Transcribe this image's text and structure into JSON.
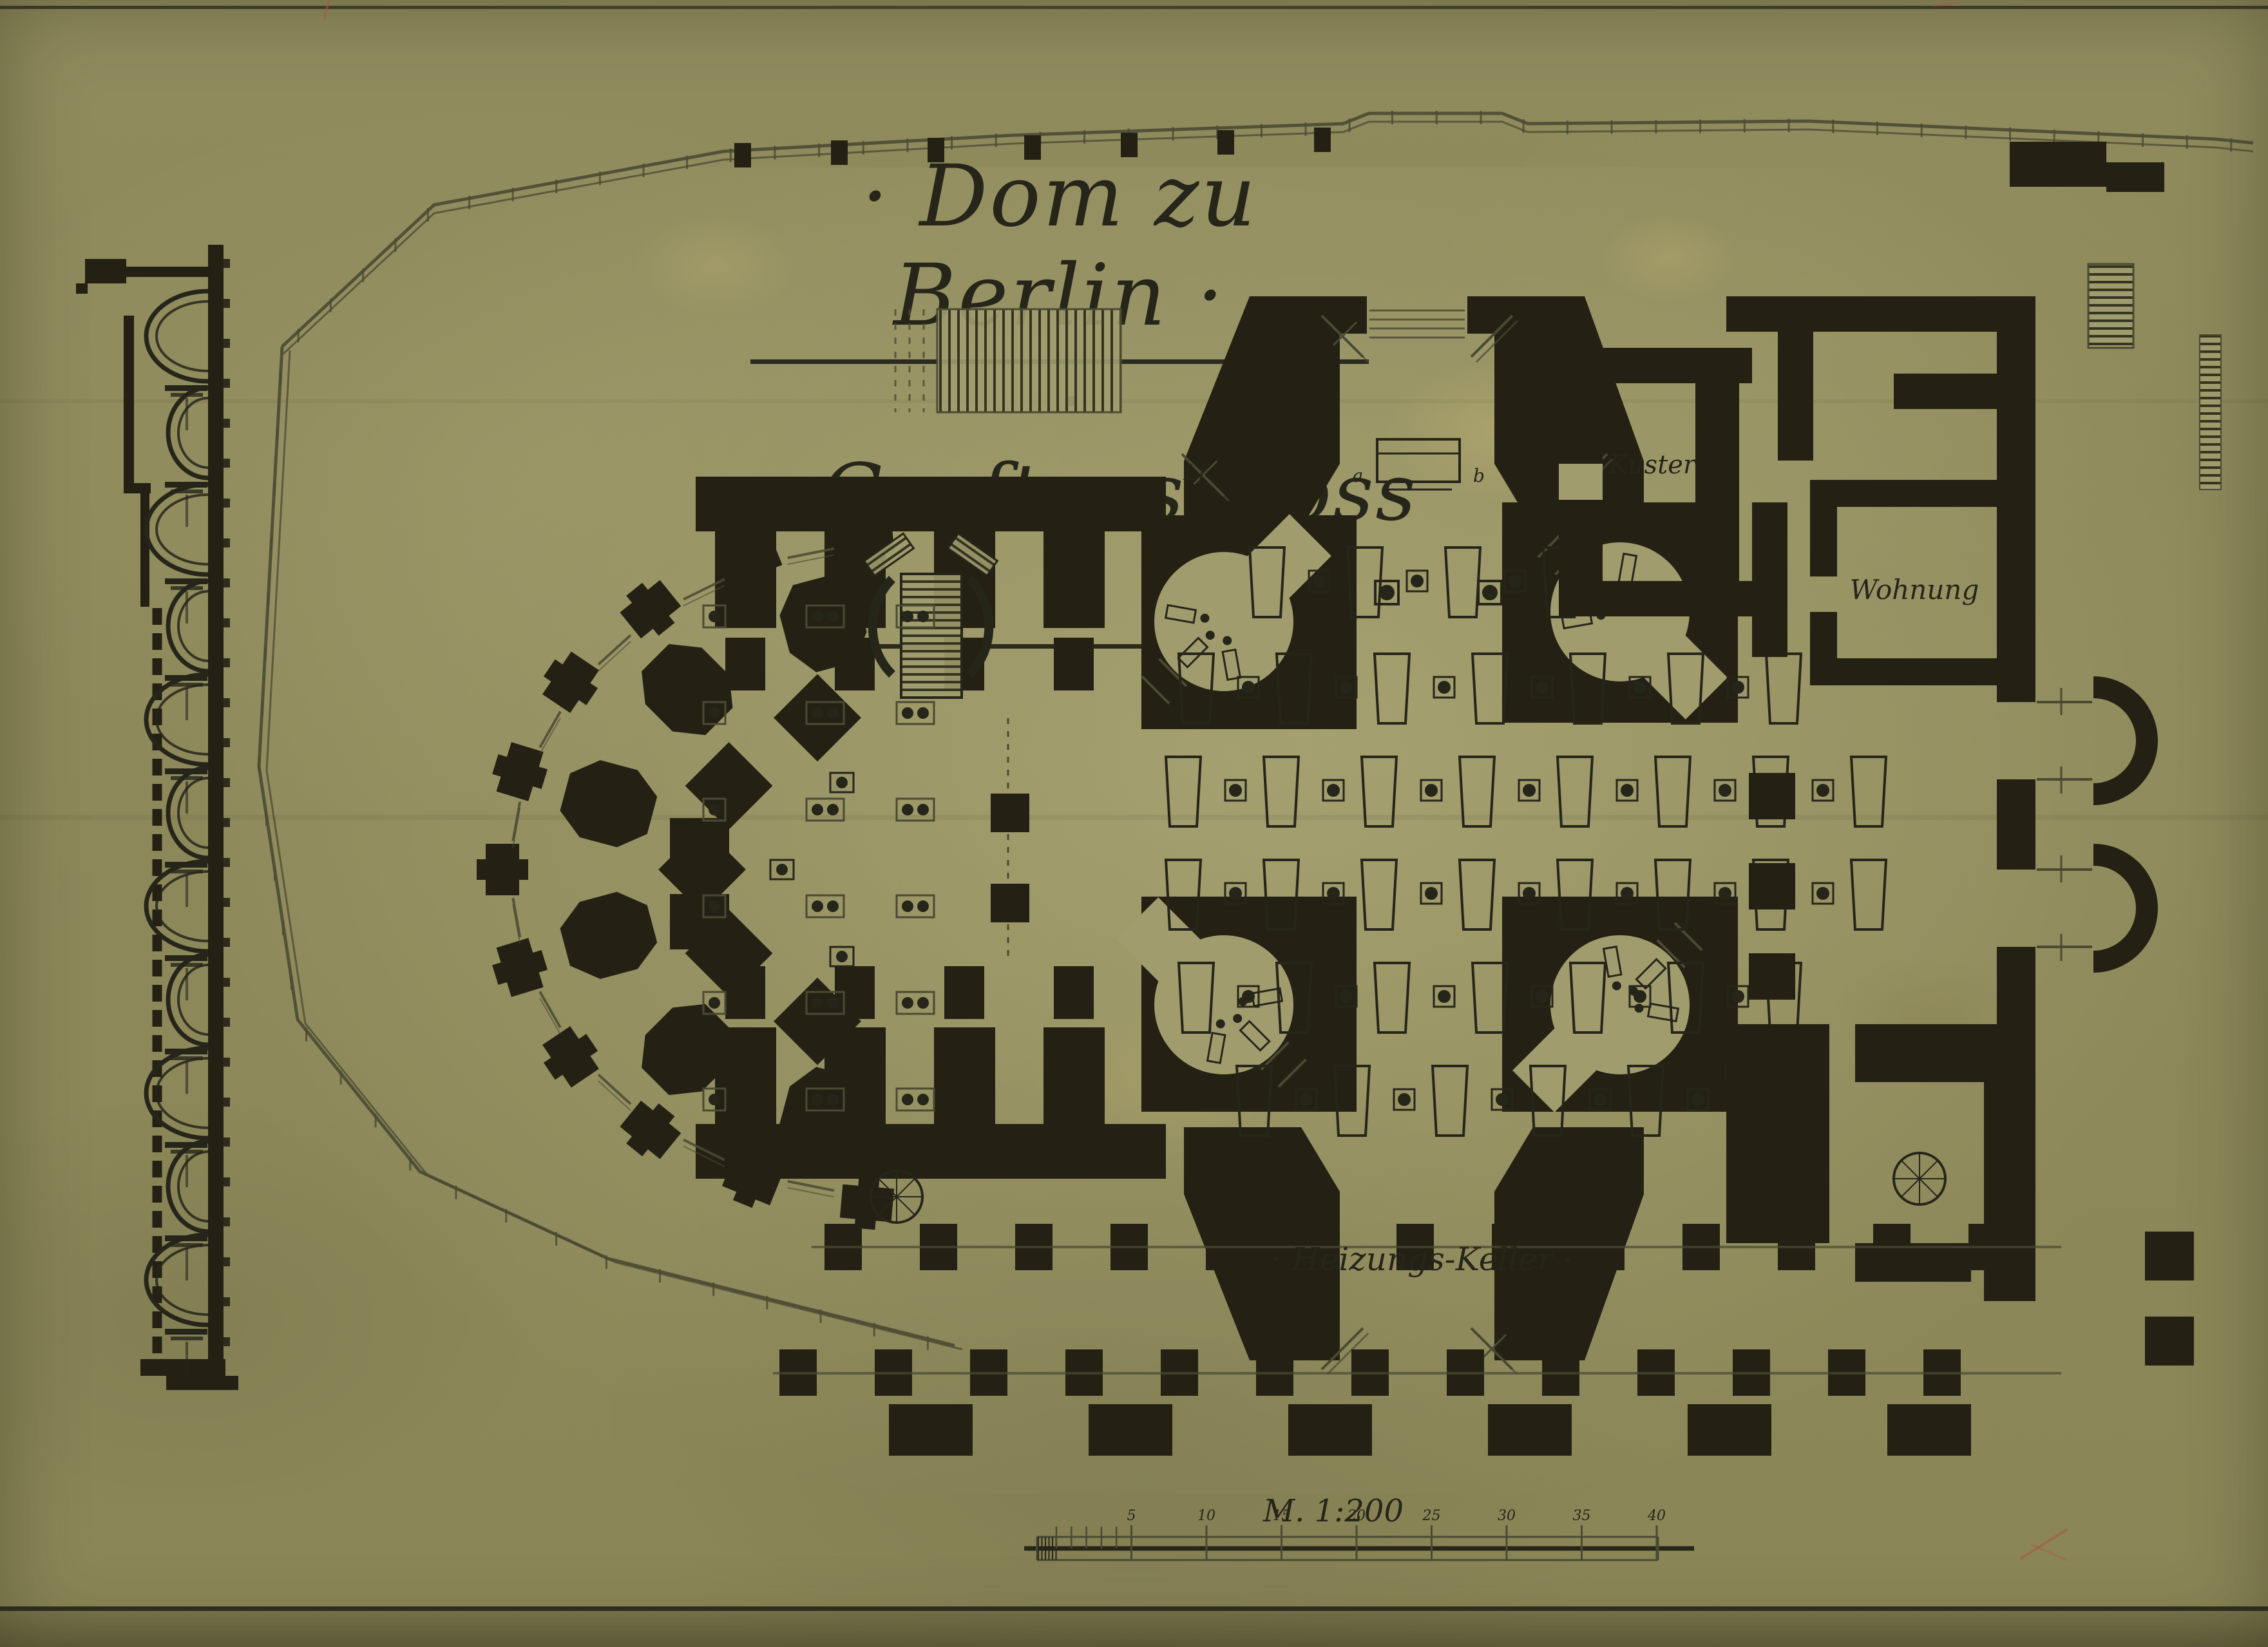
{
  "document": {
    "title_line1": "· Dom zu Berlin ·",
    "title_line2": "· Gruftgeschoss ·",
    "kind": "historical ink floor plan on aged paper"
  },
  "plan_labels": {
    "kuester": "Küster",
    "wohnung": "Wohnung",
    "heizungs_keller": "· Heizungs-Keller ·",
    "shaft": "Lf",
    "altar_a": "a",
    "altar_b": "b"
  },
  "scale": {
    "label": "M. 1:200",
    "major_tick_labels": [
      "5",
      "10",
      "15",
      "20",
      "25",
      "30",
      "35",
      "40"
    ],
    "minor_tick_count": 5
  },
  "colors": {
    "paper": "#8f8b5d",
    "paper_light": "#a5a173",
    "ink": "#26251a",
    "poche": "#242114",
    "thin_line": "#4a4a33",
    "red_mark": "#a85848"
  }
}
